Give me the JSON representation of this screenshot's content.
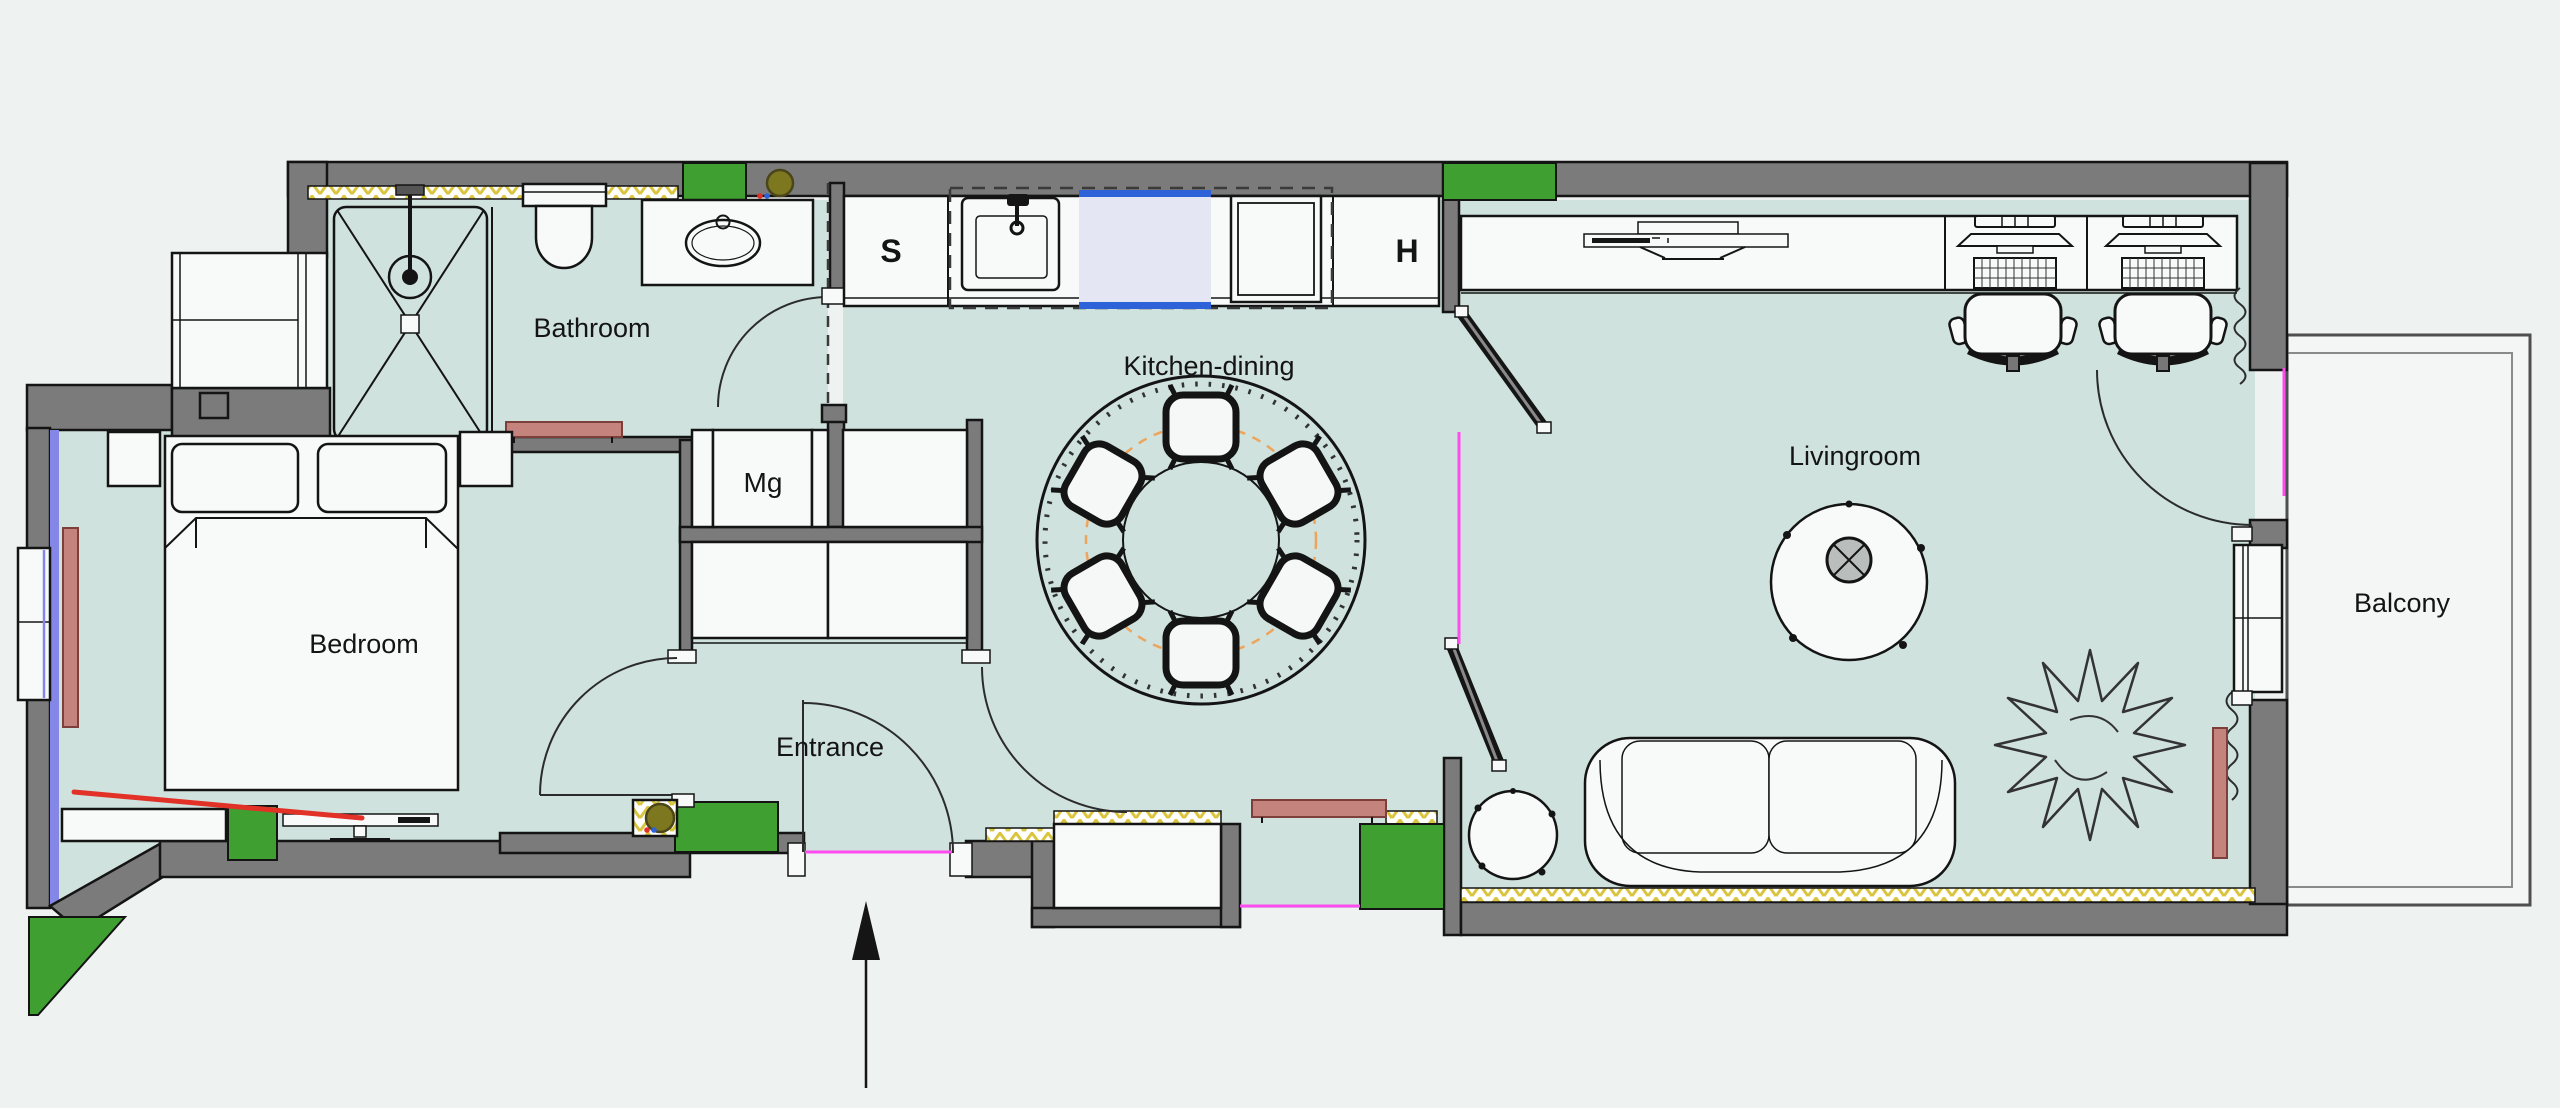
{
  "labels": {
    "bathroom": "Bathroom",
    "bedroom": "Bedroom",
    "kitchen_dining": "Kitchen-dining",
    "entrance": "Entrance",
    "livingroom": "Livingroom",
    "balcony": "Balcony",
    "cabinet_s": "S",
    "cabinet_h": "H",
    "fridge_mg": "Mg"
  },
  "colors": {
    "background": "#eef2f0",
    "floor": "#cfe2dd",
    "balcony_floor": "#f4f6f5",
    "wall": "#7b7b7b",
    "outline": "#141414",
    "furniture": "#f8faf9",
    "green": "#3f9f31",
    "insulation": "#d9c63e",
    "radiator": "#c5837e",
    "accent_magenta": "#ff4cf0",
    "accent_red": "#e23127",
    "accent_orange": "#eda45c",
    "glass_blue": "#8487e8",
    "panel_blue": "#2e62d9",
    "olive": "#7d771f"
  }
}
